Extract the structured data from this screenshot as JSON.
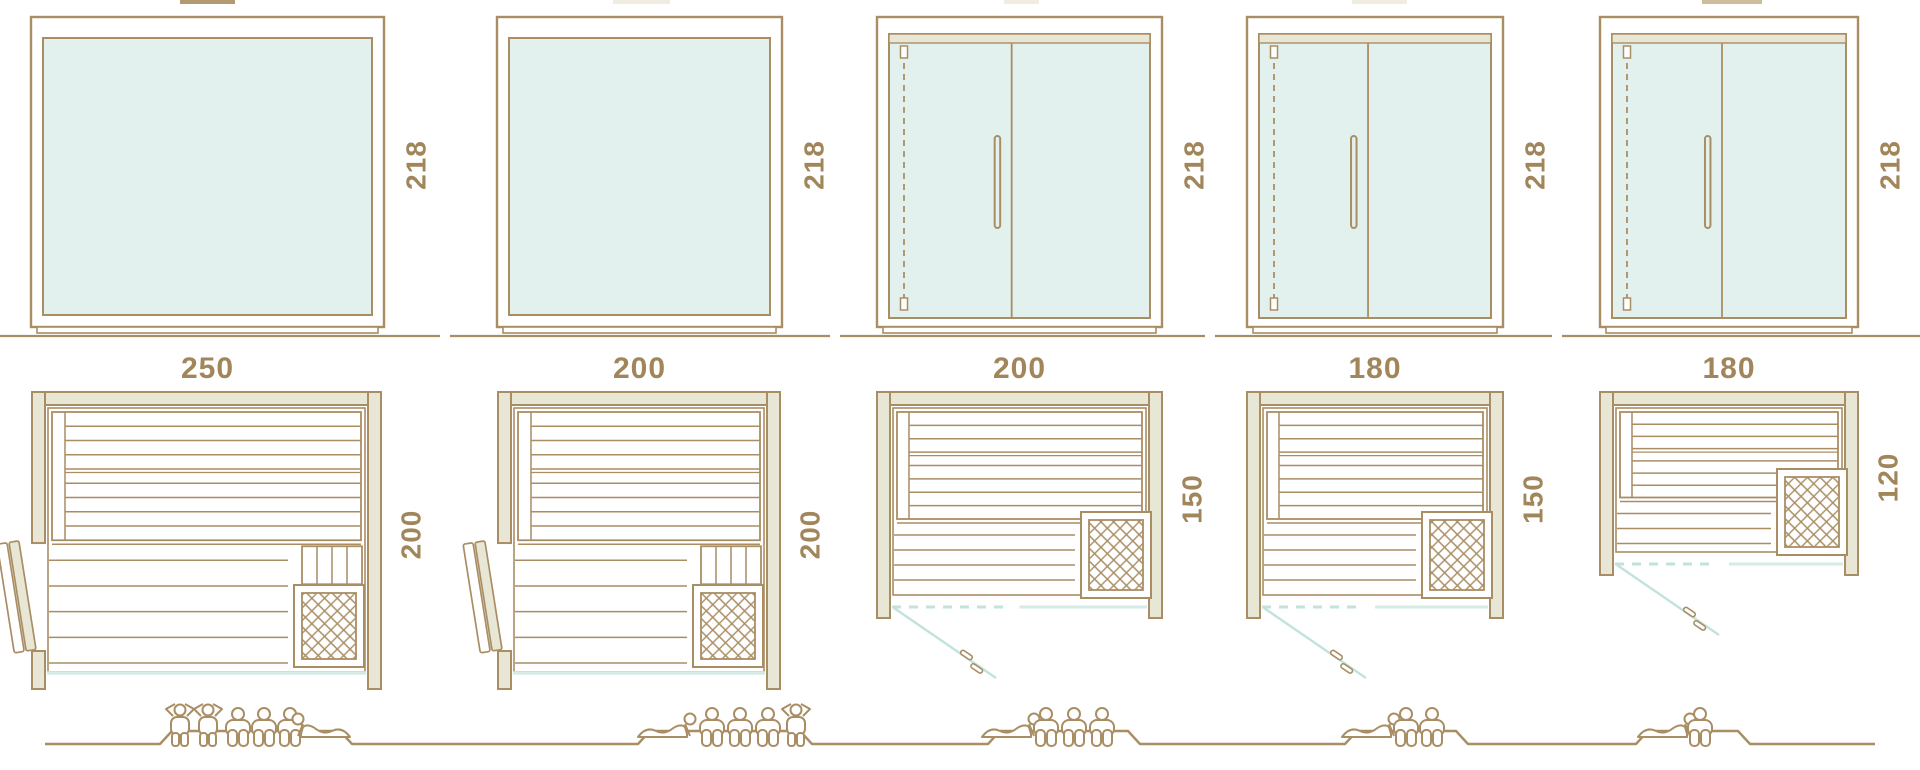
{
  "diagram_title": "sauna-size-variants-dimension-diagram",
  "units": [
    {
      "name": "unit-250x200",
      "elevation_type": "fixed-glass-front",
      "plan_type": "side-hinged-door",
      "width_label": "250",
      "height_label": "218",
      "depth_label": "200",
      "capacity_figures": [
        "standing",
        "standing",
        "seated",
        "seated",
        "seated",
        "lying-head-left"
      ]
    },
    {
      "name": "unit-200x200",
      "elevation_type": "fixed-glass-front",
      "plan_type": "side-hinged-door",
      "width_label": "200",
      "height_label": "218",
      "depth_label": "200",
      "capacity_figures": [
        "lying-head-right",
        "seated",
        "seated",
        "seated",
        "standing"
      ]
    },
    {
      "name": "unit-200x150",
      "elevation_type": "double-glass-door",
      "plan_type": "front-swing-door",
      "width_label": "200",
      "height_label": "218",
      "depth_label": "150",
      "capacity_figures": [
        "lying-head-right",
        "seated",
        "seated",
        "seated"
      ]
    },
    {
      "name": "unit-180x150",
      "elevation_type": "double-glass-door",
      "plan_type": "front-swing-door",
      "width_label": "180",
      "height_label": "218",
      "depth_label": "150",
      "capacity_figures": [
        "lying-head-right",
        "seated",
        "seated"
      ]
    },
    {
      "name": "unit-180x120",
      "elevation_type": "double-glass-door",
      "plan_type": "front-swing-door",
      "width_label": "180",
      "height_label": "218",
      "depth_label": "120",
      "capacity_figures": [
        "lying-head-right",
        "seated"
      ]
    }
  ],
  "colors": {
    "line_brown": "#a98e64",
    "label_brown": "#a2865b",
    "wall_tan": "#e8e6d4",
    "glass_mint": "#e3f1ee",
    "door_teal": "#c2e2dd",
    "front_glass_teal": "#d6ebe7",
    "background": "#ffffff"
  }
}
